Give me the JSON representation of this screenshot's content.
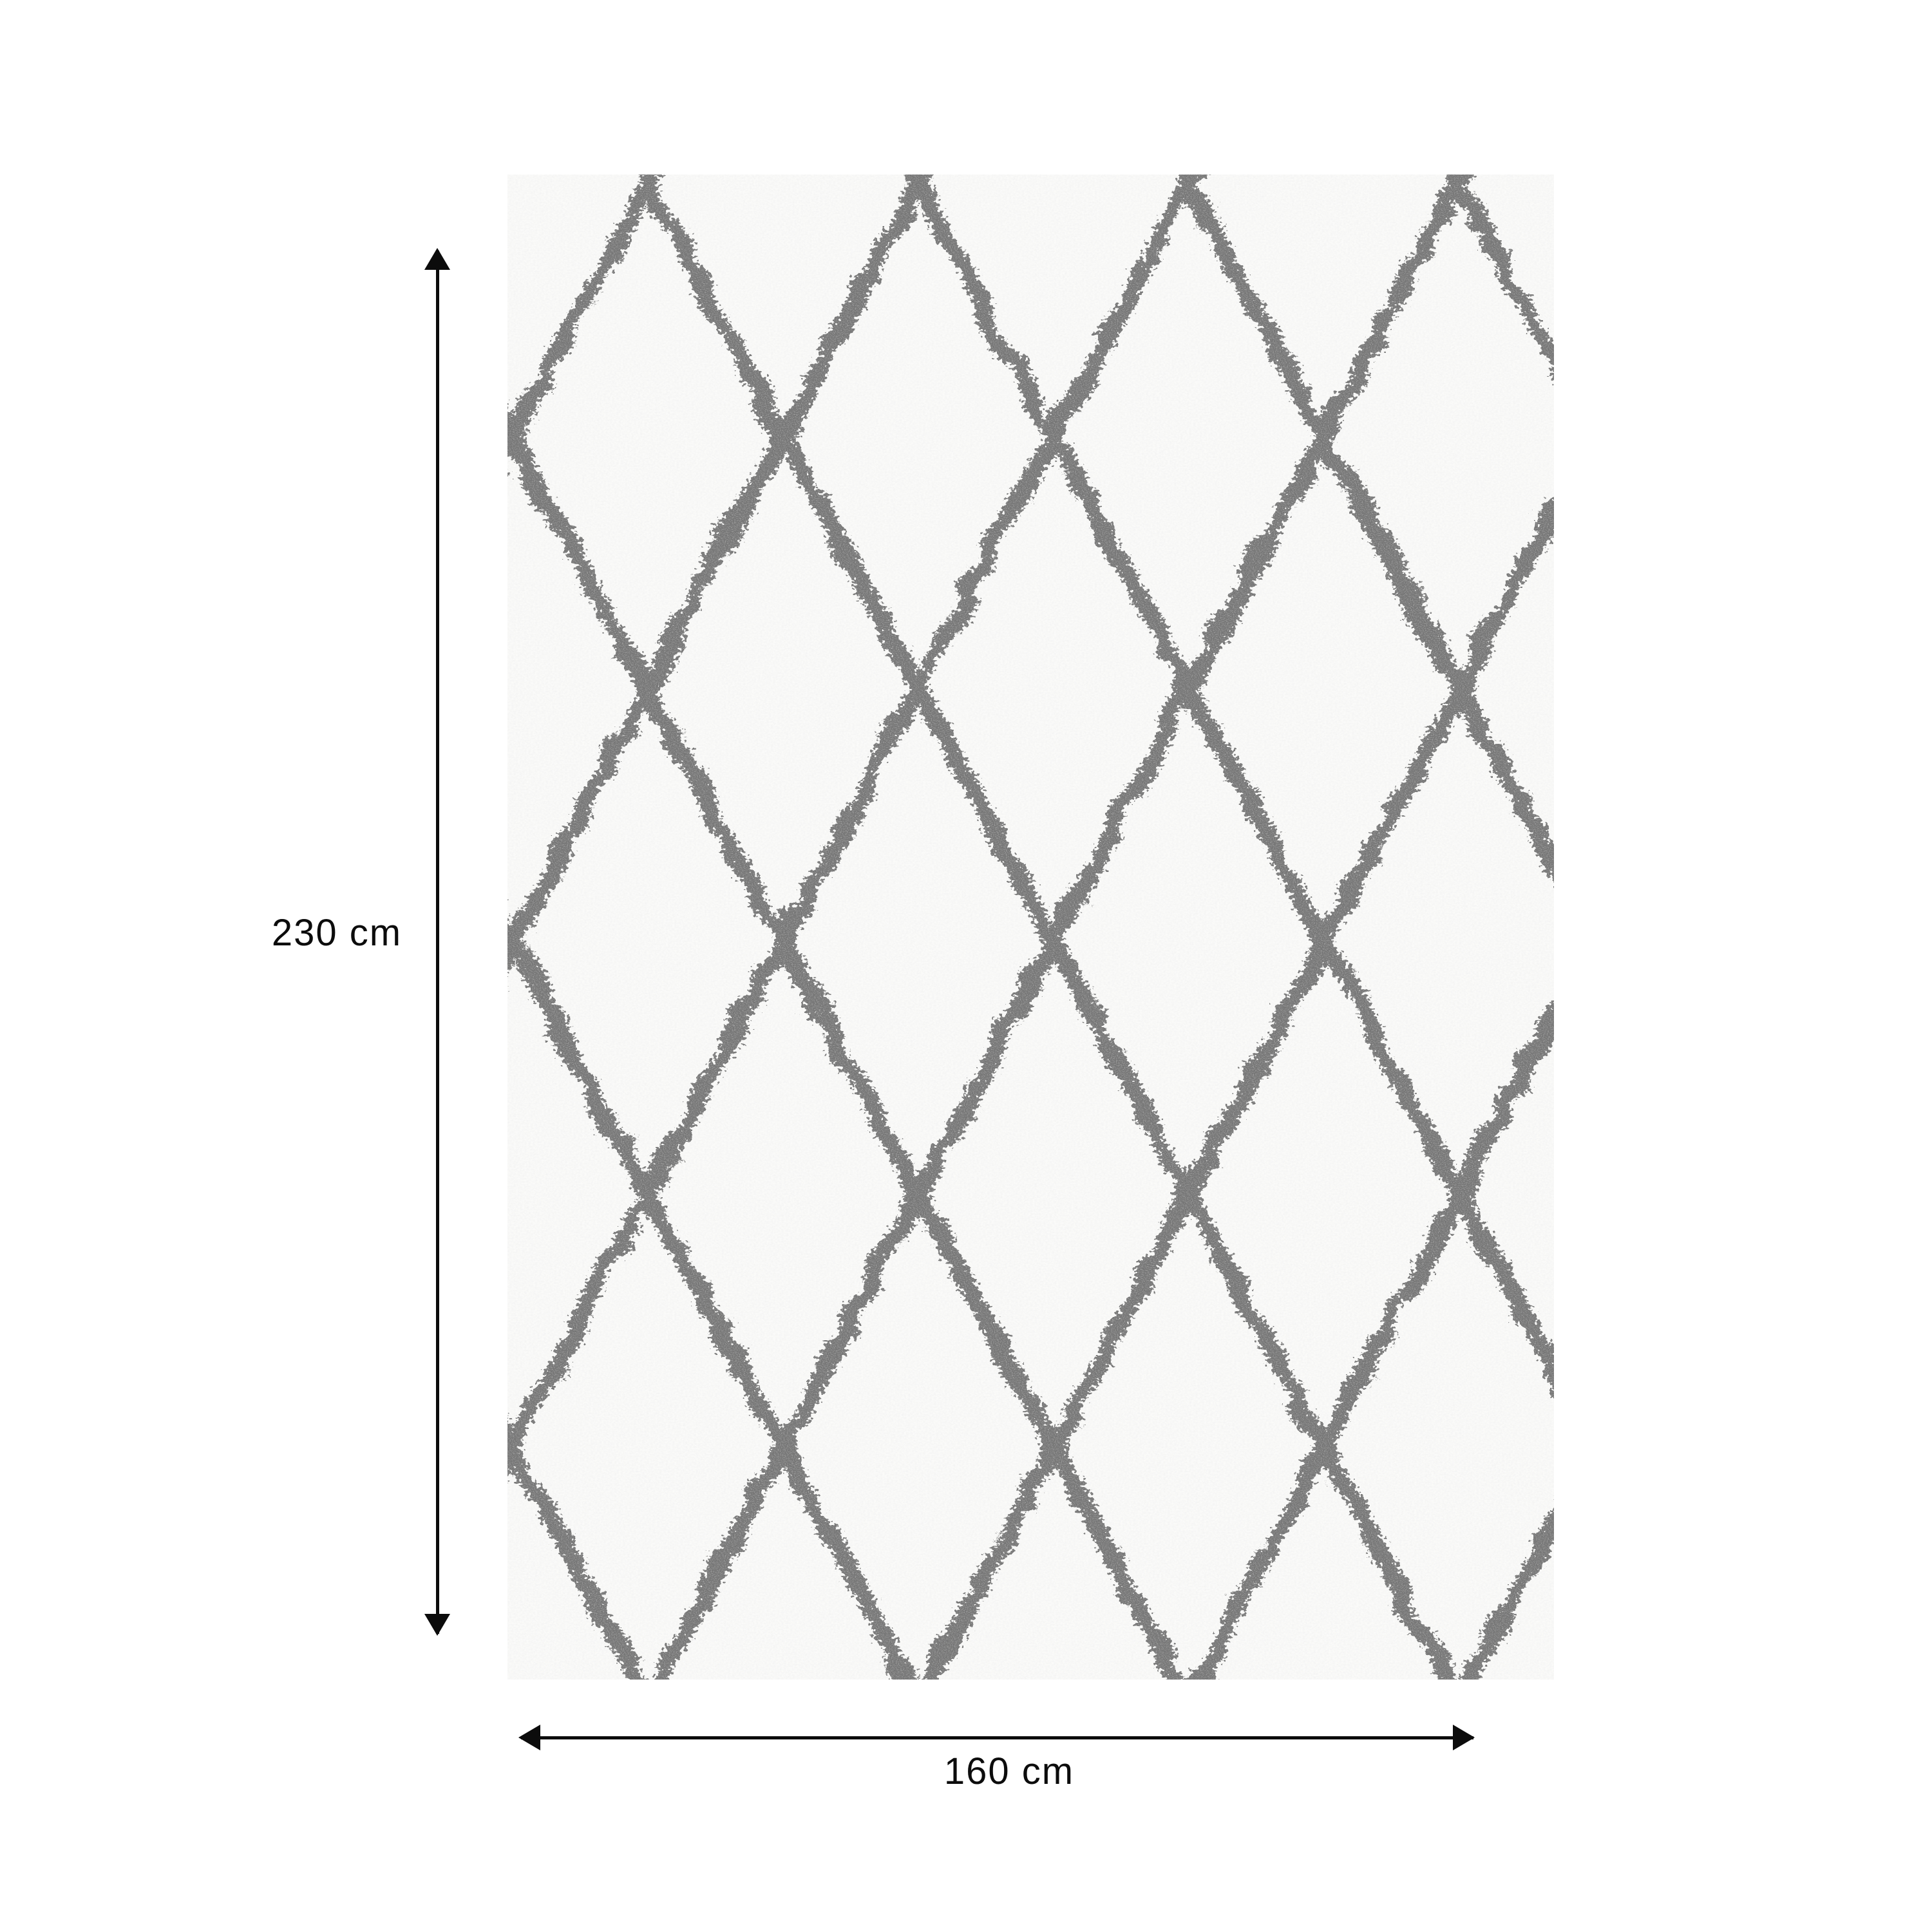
{
  "diagram": {
    "kind": "product-dimension-diagram",
    "product": {
      "type": "shaggy berber-style rug",
      "pattern": "diamond trellis",
      "pattern_color_name": "grey",
      "base_color_name": "cream white"
    }
  },
  "dimensions": {
    "height": {
      "label": "230 cm",
      "value": 230,
      "unit": "cm"
    },
    "width": {
      "label": "160 cm",
      "value": 160,
      "unit": "cm"
    }
  },
  "colors": {
    "annotation": "#0c0c0c",
    "rug_base": "#f2f2f0",
    "rug_pattern_line": "#6f6f6f",
    "page_background": "#ffffff"
  }
}
